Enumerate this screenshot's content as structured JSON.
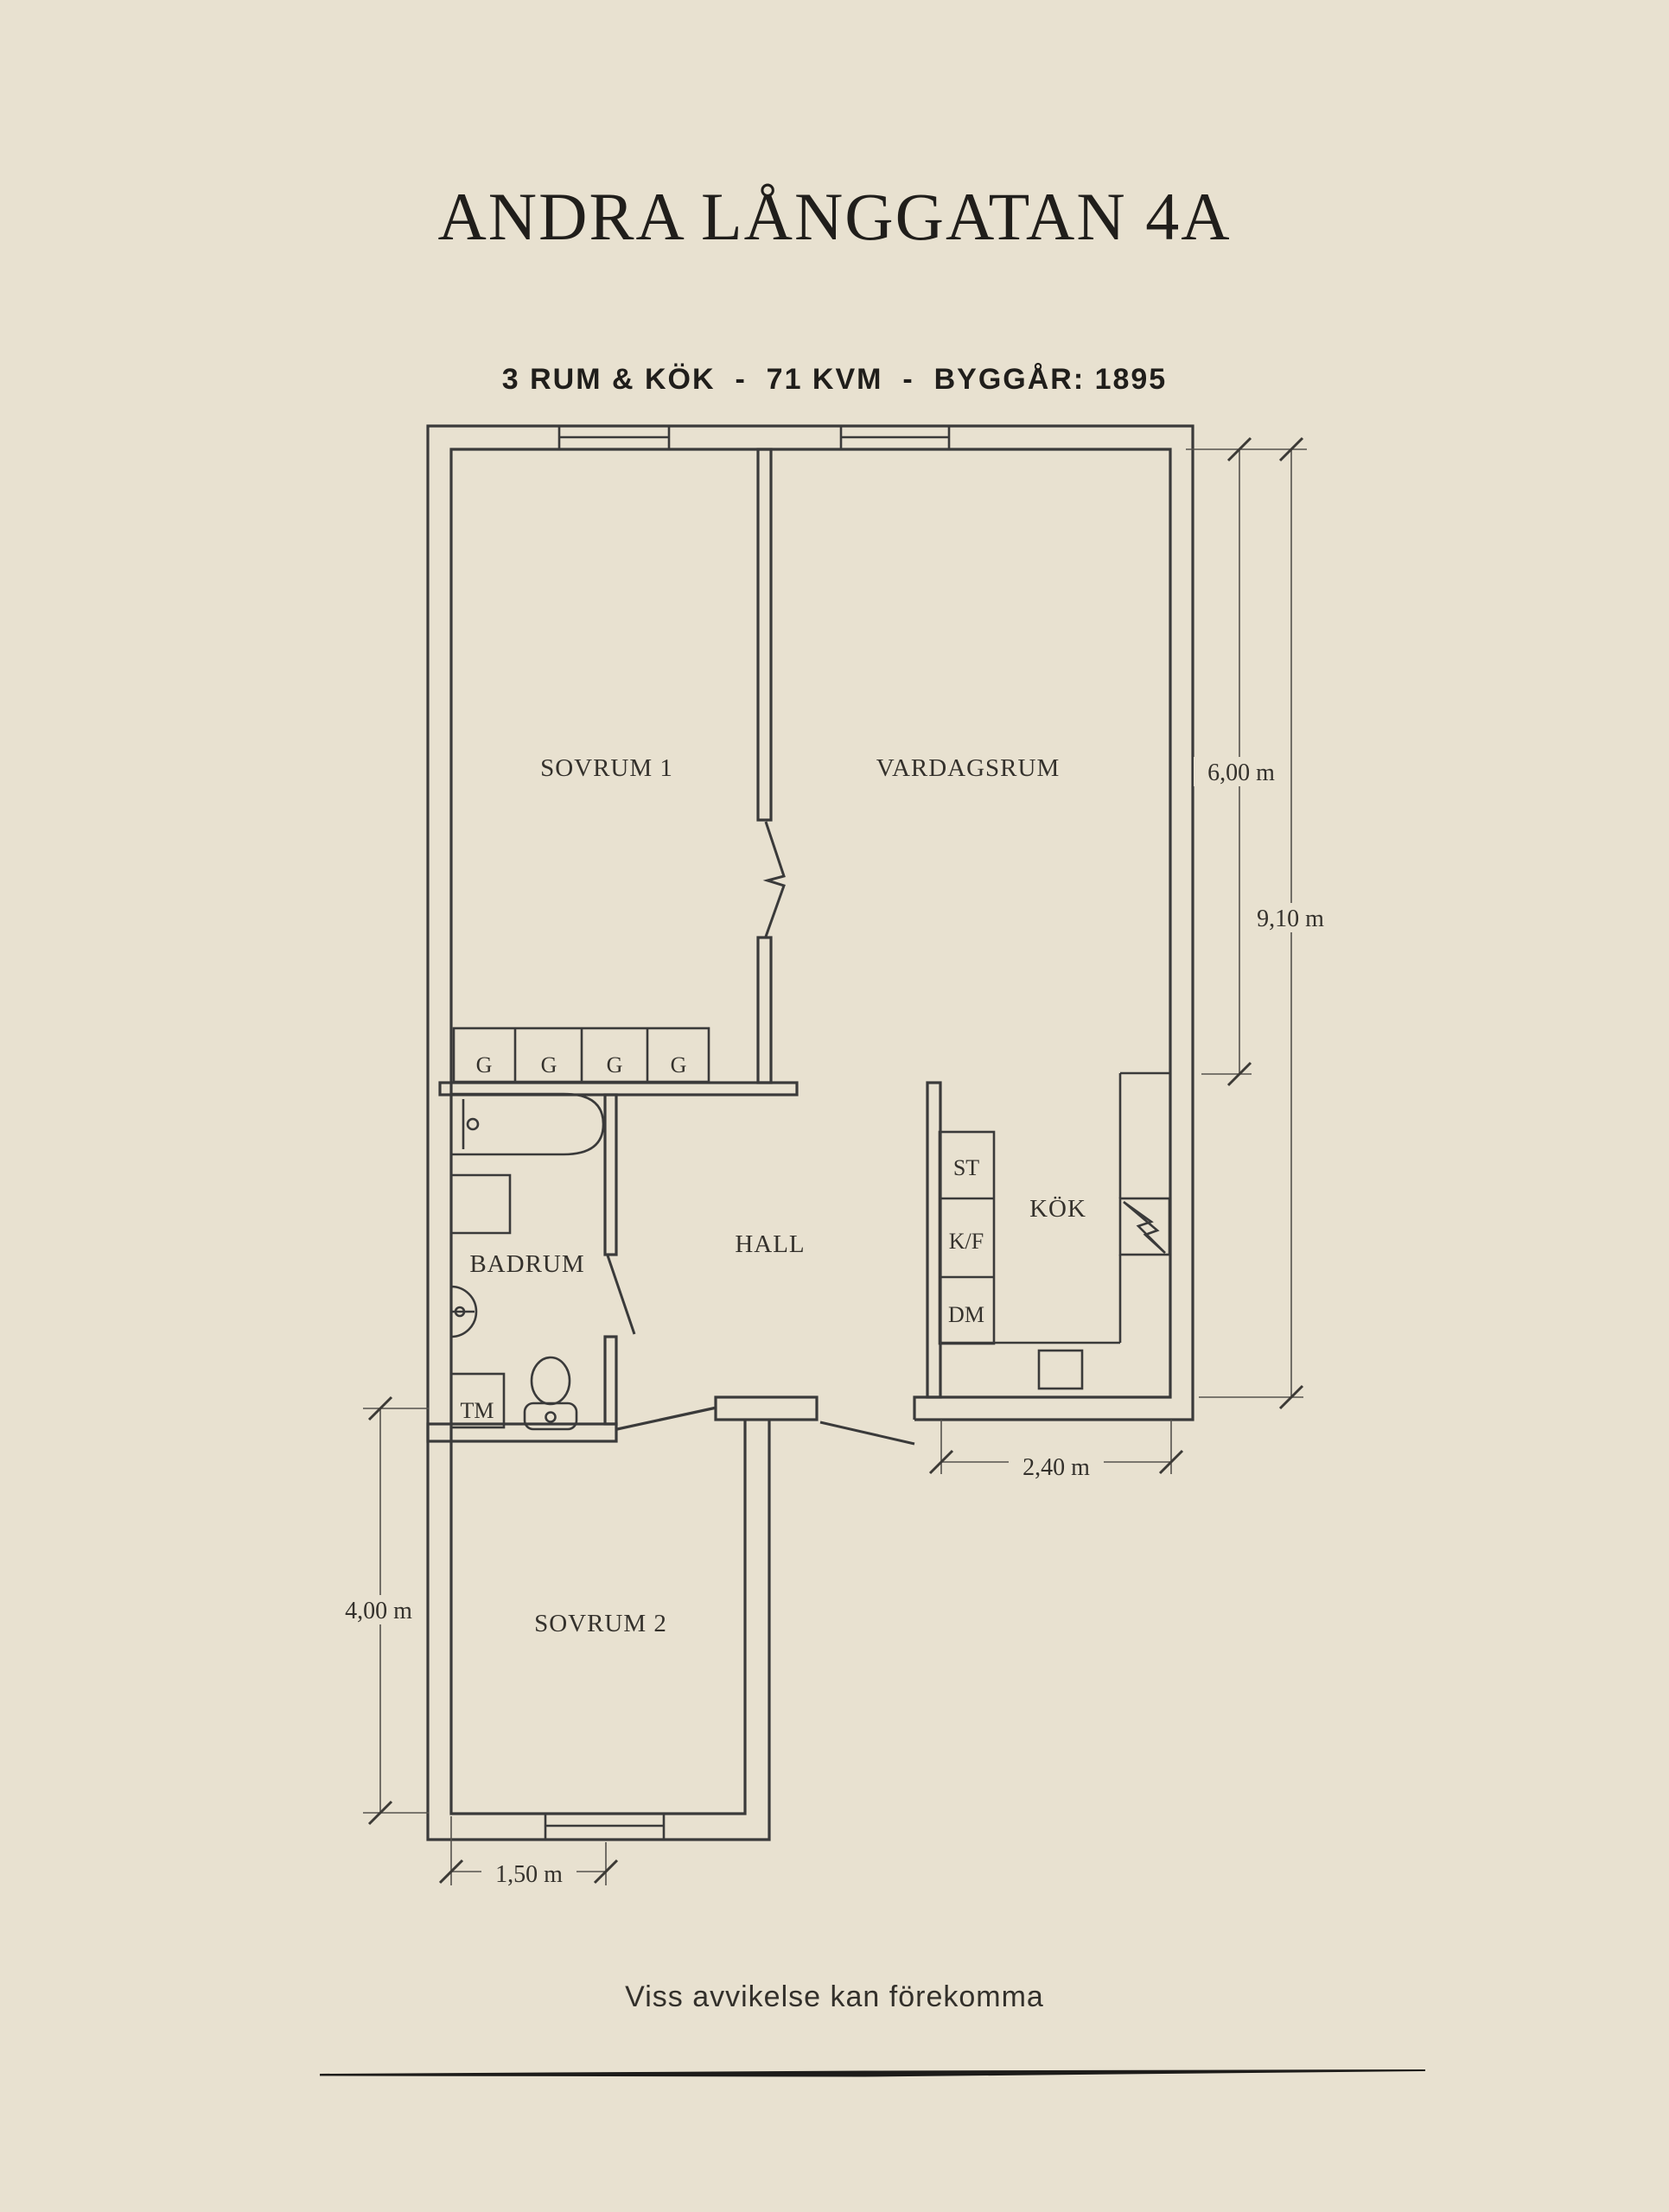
{
  "header": {
    "title": "ANDRA LÅNGGATAN 4A",
    "subtitle": "3 RUM & KÖK  -  71 KVM  -  BYGGÅR: 1895"
  },
  "floorplan": {
    "rooms": {
      "sovrum1": "SOVRUM 1",
      "vardagsrum": "VARDAGSRUM",
      "kok": "KÖK",
      "hall": "HALL",
      "badrum": "BADRUM",
      "sovrum2": "SOVRUM 2"
    },
    "fixtures": {
      "closets": [
        "G",
        "G",
        "G",
        "G"
      ],
      "pantry": "ST",
      "fridge_freezer": "K/F",
      "dishwasher": "DM",
      "washing_machine": "TM"
    },
    "dimensions": {
      "living_room_height": "6,00 m",
      "right_side_total": "9,10 m",
      "kitchen_width": "2,40 m",
      "bedroom2_height": "4,00 m",
      "bedroom2_window_offset": "1,50 m"
    }
  },
  "footer": {
    "disclaimer": "Viss avvikelse kan förekomma"
  },
  "colors": {
    "background": "#e8e1d0",
    "wall": "#3a3a3a",
    "dimension": "#55524d",
    "text": "#34312c",
    "title": "#201e1b"
  }
}
